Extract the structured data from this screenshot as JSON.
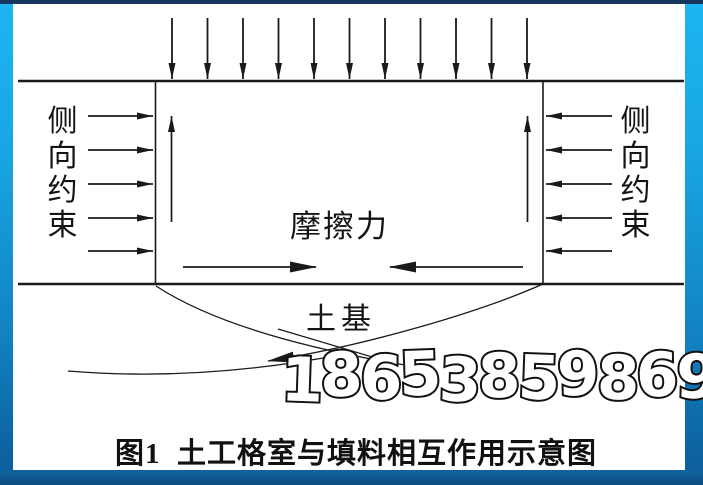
{
  "figure": {
    "caption": "图1  土工格室与填料相互作用示意图",
    "caption_number": "图1",
    "caption_title": "土工格室与填料相互作用示意图",
    "labels": {
      "left_lateral_constraint": "侧向约束",
      "right_lateral_constraint": "侧向约束",
      "friction_force": "摩擦力",
      "subgrade": "土基"
    },
    "watermark": "18653859869",
    "annotations": {
      "top_load_arrows": {
        "count": 11,
        "direction": "down"
      },
      "left_constraint_arrows": {
        "count": 5,
        "direction": "right"
      },
      "right_constraint_arrows": {
        "count": 5,
        "direction": "left"
      },
      "inner_vertical_arrows": {
        "count": 2,
        "direction": "up"
      },
      "friction_arrows": {
        "count": 2,
        "directions": [
          "right",
          "left"
        ]
      },
      "slip_surface_arrow": {
        "count": 1,
        "direction": "down-left"
      }
    },
    "colors": {
      "line_color": "#1a1a1a",
      "canvas_background": "#ffffff",
      "frame_gradient_top": "#1db5f2",
      "frame_gradient_bottom": "#0c5a98",
      "frame_top_bar": "#15365e",
      "watermark_fill": "#ffffff",
      "watermark_outline": "#111111"
    }
  }
}
